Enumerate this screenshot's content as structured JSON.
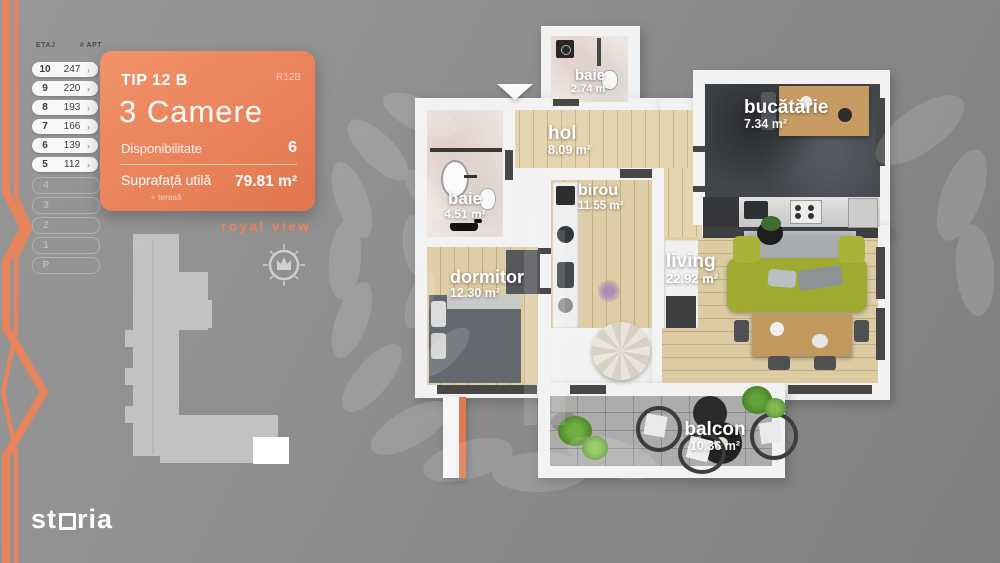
{
  "floor_table": {
    "col_etaj": "ETAJ",
    "col_apt": "# APT",
    "chevron": "›",
    "rows": [
      {
        "etaj": "10",
        "apt": "247"
      },
      {
        "etaj": "9",
        "apt": "220"
      },
      {
        "etaj": "8",
        "apt": "193"
      },
      {
        "etaj": "7",
        "apt": "166"
      },
      {
        "etaj": "6",
        "apt": "139"
      },
      {
        "etaj": "5",
        "apt": "112"
      }
    ],
    "disabled_rows": [
      {
        "etaj": "4"
      },
      {
        "etaj": "3"
      },
      {
        "etaj": "2"
      },
      {
        "etaj": "1"
      },
      {
        "etaj": "P"
      }
    ]
  },
  "info_card": {
    "type_label": "TIP 12 B",
    "code": "R12B",
    "rooms_title": "3 Camere",
    "availability_label": "Disponibilitate",
    "availability_value": "6",
    "area_label": "Suprafață utilă",
    "area_sublabel": "+ terasă",
    "area_value": "79.81 m²"
  },
  "brand": {
    "project": "royal view",
    "site_part1": "st",
    "site_part2": "ria"
  },
  "plan": {
    "rooms": [
      {
        "name": "baie",
        "area": "2.74 m²"
      },
      {
        "name": "bucătărie",
        "area": "7.34 m²"
      },
      {
        "name": "hol",
        "area": "8.09 m²"
      },
      {
        "name": "baie",
        "area": "4.51 m²"
      },
      {
        "name": "birou",
        "area": "11.55 m²"
      },
      {
        "name": "dormitor",
        "area": "12.30 m²"
      },
      {
        "name": "living",
        "area": "22.92 m²"
      },
      {
        "name": "balcon",
        "area": "10.36 m²"
      }
    ]
  },
  "colors": {
    "accent": "#e8845c",
    "wall": "#f3f3f3",
    "wood_floor": "#decda6",
    "kitchen_floor": "#42454a",
    "balcony_tile": "#adacaa",
    "sofa_green": "#9faa30"
  }
}
